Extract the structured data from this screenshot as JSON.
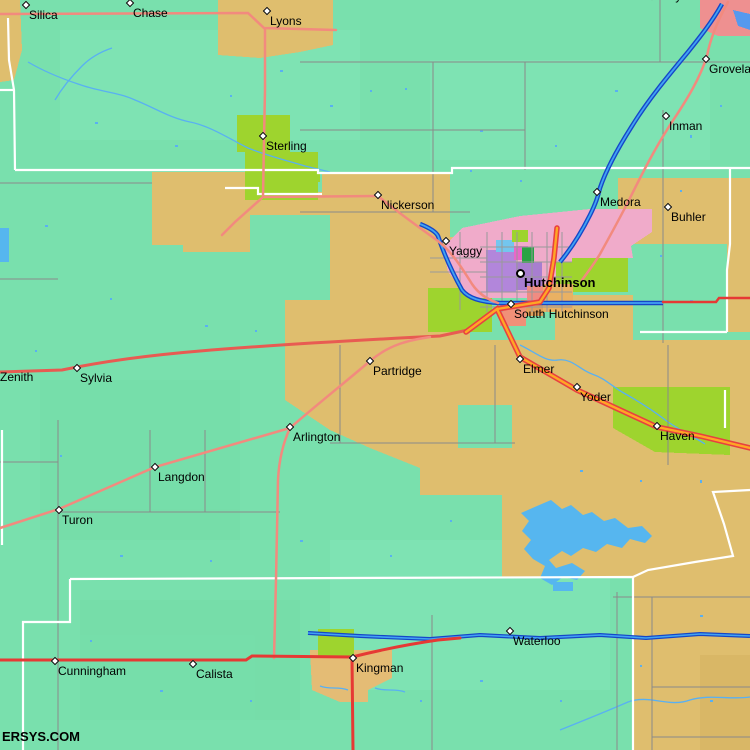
{
  "watermark": "ERSYS.COM",
  "map": {
    "places": [
      {
        "id": "silica",
        "name": "Silica",
        "marker": {
          "type": "diamond",
          "x": 26,
          "y": 5
        },
        "label": {
          "x": 29,
          "y": 9,
          "bold": false
        }
      },
      {
        "id": "chase",
        "name": "Chase",
        "marker": {
          "type": "diamond",
          "x": 130,
          "y": 3
        },
        "label": {
          "x": 133,
          "y": 7,
          "bold": false
        }
      },
      {
        "id": "lyons",
        "name": "Lyons",
        "marker": {
          "type": "diamond",
          "x": 267,
          "y": 11
        },
        "label": {
          "x": 270,
          "y": 15,
          "bold": false
        }
      },
      {
        "id": "conway",
        "name": "Conway",
        "marker": {
          "type": "diamond",
          "x": 652,
          "y": -4
        },
        "label": {
          "x": 638,
          "y": -10,
          "bold": false
        }
      },
      {
        "id": "groveland",
        "name": "Groveland",
        "marker": {
          "type": "diamond",
          "x": 706,
          "y": 59
        },
        "label": {
          "x": 709,
          "y": 63,
          "bold": false
        }
      },
      {
        "id": "inman",
        "name": "Inman",
        "marker": {
          "type": "diamond",
          "x": 666,
          "y": 116
        },
        "label": {
          "x": 669,
          "y": 120,
          "bold": false
        }
      },
      {
        "id": "sterling",
        "name": "Sterling",
        "marker": {
          "type": "diamond",
          "x": 263,
          "y": 136
        },
        "label": {
          "x": 266,
          "y": 140,
          "bold": false
        }
      },
      {
        "id": "nickerson",
        "name": "Nickerson",
        "marker": {
          "type": "diamond",
          "x": 378,
          "y": 195
        },
        "label": {
          "x": 381,
          "y": 199,
          "bold": false
        }
      },
      {
        "id": "medora",
        "name": "Medora",
        "marker": {
          "type": "diamond",
          "x": 597,
          "y": 192
        },
        "label": {
          "x": 600,
          "y": 196,
          "bold": false
        }
      },
      {
        "id": "buhler",
        "name": "Buhler",
        "marker": {
          "type": "diamond",
          "x": 668,
          "y": 207
        },
        "label": {
          "x": 671,
          "y": 211,
          "bold": false
        }
      },
      {
        "id": "yaggy",
        "name": "Yaggy",
        "marker": {
          "type": "diamond",
          "x": 446,
          "y": 241
        },
        "label": {
          "x": 449,
          "y": 245,
          "bold": false
        }
      },
      {
        "id": "hutchinson",
        "name": "Hutchinson",
        "marker": {
          "type": "circle",
          "x": 520,
          "y": 273
        },
        "label": {
          "x": 524,
          "y": 277,
          "bold": true
        }
      },
      {
        "id": "south-hutchinson",
        "name": "South Hutchinson",
        "marker": {
          "type": "diamond",
          "x": 511,
          "y": 304
        },
        "label": {
          "x": 514,
          "y": 308,
          "bold": false
        }
      },
      {
        "id": "elmer",
        "name": "Elmer",
        "marker": {
          "type": "diamond",
          "x": 520,
          "y": 359
        },
        "label": {
          "x": 523,
          "y": 363,
          "bold": false
        }
      },
      {
        "id": "yoder",
        "name": "Yoder",
        "marker": {
          "type": "diamond",
          "x": 577,
          "y": 387
        },
        "label": {
          "x": 580,
          "y": 391,
          "bold": false
        }
      },
      {
        "id": "haven",
        "name": "Haven",
        "marker": {
          "type": "diamond",
          "x": 657,
          "y": 426
        },
        "label": {
          "x": 660,
          "y": 430,
          "bold": false
        }
      },
      {
        "id": "partridge",
        "name": "Partridge",
        "marker": {
          "type": "diamond",
          "x": 370,
          "y": 361
        },
        "label": {
          "x": 373,
          "y": 365,
          "bold": false
        }
      },
      {
        "id": "arlington",
        "name": "Arlington",
        "marker": {
          "type": "diamond",
          "x": 290,
          "y": 427
        },
        "label": {
          "x": 293,
          "y": 431,
          "bold": false
        }
      },
      {
        "id": "zenith",
        "name": "Zenith",
        "marker": null,
        "label": {
          "x": 0,
          "y": 371,
          "bold": false
        }
      },
      {
        "id": "sylvia",
        "name": "Sylvia",
        "marker": {
          "type": "diamond",
          "x": 77,
          "y": 368
        },
        "label": {
          "x": 80,
          "y": 372,
          "bold": false
        }
      },
      {
        "id": "langdon",
        "name": "Langdon",
        "marker": {
          "type": "diamond",
          "x": 155,
          "y": 467
        },
        "label": {
          "x": 158,
          "y": 471,
          "bold": false
        }
      },
      {
        "id": "turon",
        "name": "Turon",
        "marker": {
          "type": "diamond",
          "x": 59,
          "y": 510
        },
        "label": {
          "x": 62,
          "y": 514,
          "bold": false
        }
      },
      {
        "id": "cunningham",
        "name": "Cunningham",
        "marker": {
          "type": "diamond",
          "x": 55,
          "y": 661
        },
        "label": {
          "x": 58,
          "y": 665,
          "bold": false
        }
      },
      {
        "id": "calista",
        "name": "Calista",
        "marker": {
          "type": "diamond",
          "x": 193,
          "y": 664
        },
        "label": {
          "x": 196,
          "y": 668,
          "bold": false
        }
      },
      {
        "id": "kingman",
        "name": "Kingman",
        "marker": {
          "type": "diamond",
          "x": 353,
          "y": 658
        },
        "label": {
          "x": 356,
          "y": 662,
          "bold": false
        }
      },
      {
        "id": "waterloo",
        "name": "Waterloo",
        "marker": {
          "type": "diamond",
          "x": 510,
          "y": 631
        },
        "label": {
          "x": 513,
          "y": 635,
          "bold": false
        }
      }
    ]
  },
  "colors": {
    "terrain_teal": "#79E0AD",
    "terrain_teal_light": "#84E6B9",
    "farmland_tan": "#DFBE6E",
    "farmland_tan_warm": "#E4BC75",
    "town_chartreuse": "#9ED42E",
    "urban_pink": "#F0ABCA",
    "urban_salmon_block": "#EE9090",
    "lake_blue": "#56B6EF",
    "river_fill": "#41A3F2",
    "river_casing": "#1546C8",
    "creek_blue": "#59B0F2",
    "road_salmon": "#F28A7E",
    "road_red": "#E63934",
    "road_dark_red": "#E85B52",
    "highway_orange": "#FFA625",
    "highway_casing": "#E84040",
    "boundary_white": "#FFFFFF",
    "section_line_gray": "#8A8A8A",
    "label_black": "#000000"
  }
}
